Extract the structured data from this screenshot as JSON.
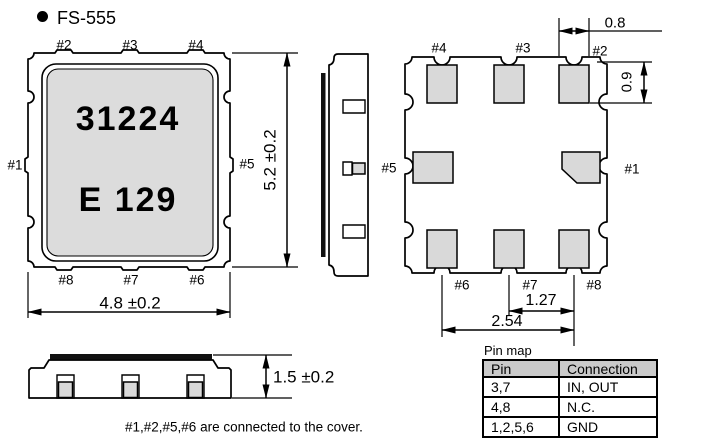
{
  "title": {
    "text": "FS-555"
  },
  "top_view": {
    "marking_line1": "31224",
    "marking_line2": "E 129",
    "pins": {
      "top": [
        "#2",
        "#3",
        "#4"
      ],
      "left": "#1",
      "right": "#5",
      "bottom": [
        "#8",
        "#7",
        "#6"
      ]
    },
    "dim_width": "4.8 ±0.2",
    "dim_height": "5.2 ±0.2"
  },
  "bottom_view": {
    "pins": {
      "top": [
        "#4",
        "#3",
        "#2"
      ],
      "left": "#5",
      "right": "#1",
      "bottom": [
        "#6",
        "#7",
        "#8"
      ]
    },
    "dim_pad_width": "0.8",
    "dim_pad_height": "0.9",
    "dim_pitch_inner": "1.27",
    "dim_pitch_outer": "2.54"
  },
  "front_view": {
    "dim_height": "1.5 ±0.2"
  },
  "note": "#1,#2,#5,#6 are connected to the cover.",
  "pin_map": {
    "caption": "Pin map",
    "headers": [
      "Pin",
      "Connection"
    ],
    "rows": [
      {
        "pin": "3,7",
        "connection": "IN, OUT"
      },
      {
        "pin": "4,8",
        "connection": "N.C."
      },
      {
        "pin": "1,2,5,6",
        "connection": "GND"
      }
    ]
  },
  "colors": {
    "line": "#000000",
    "pad_gray": "#d9d9d9",
    "cover_gray": "#dcdcdc",
    "header_gray": "#cacaca"
  }
}
